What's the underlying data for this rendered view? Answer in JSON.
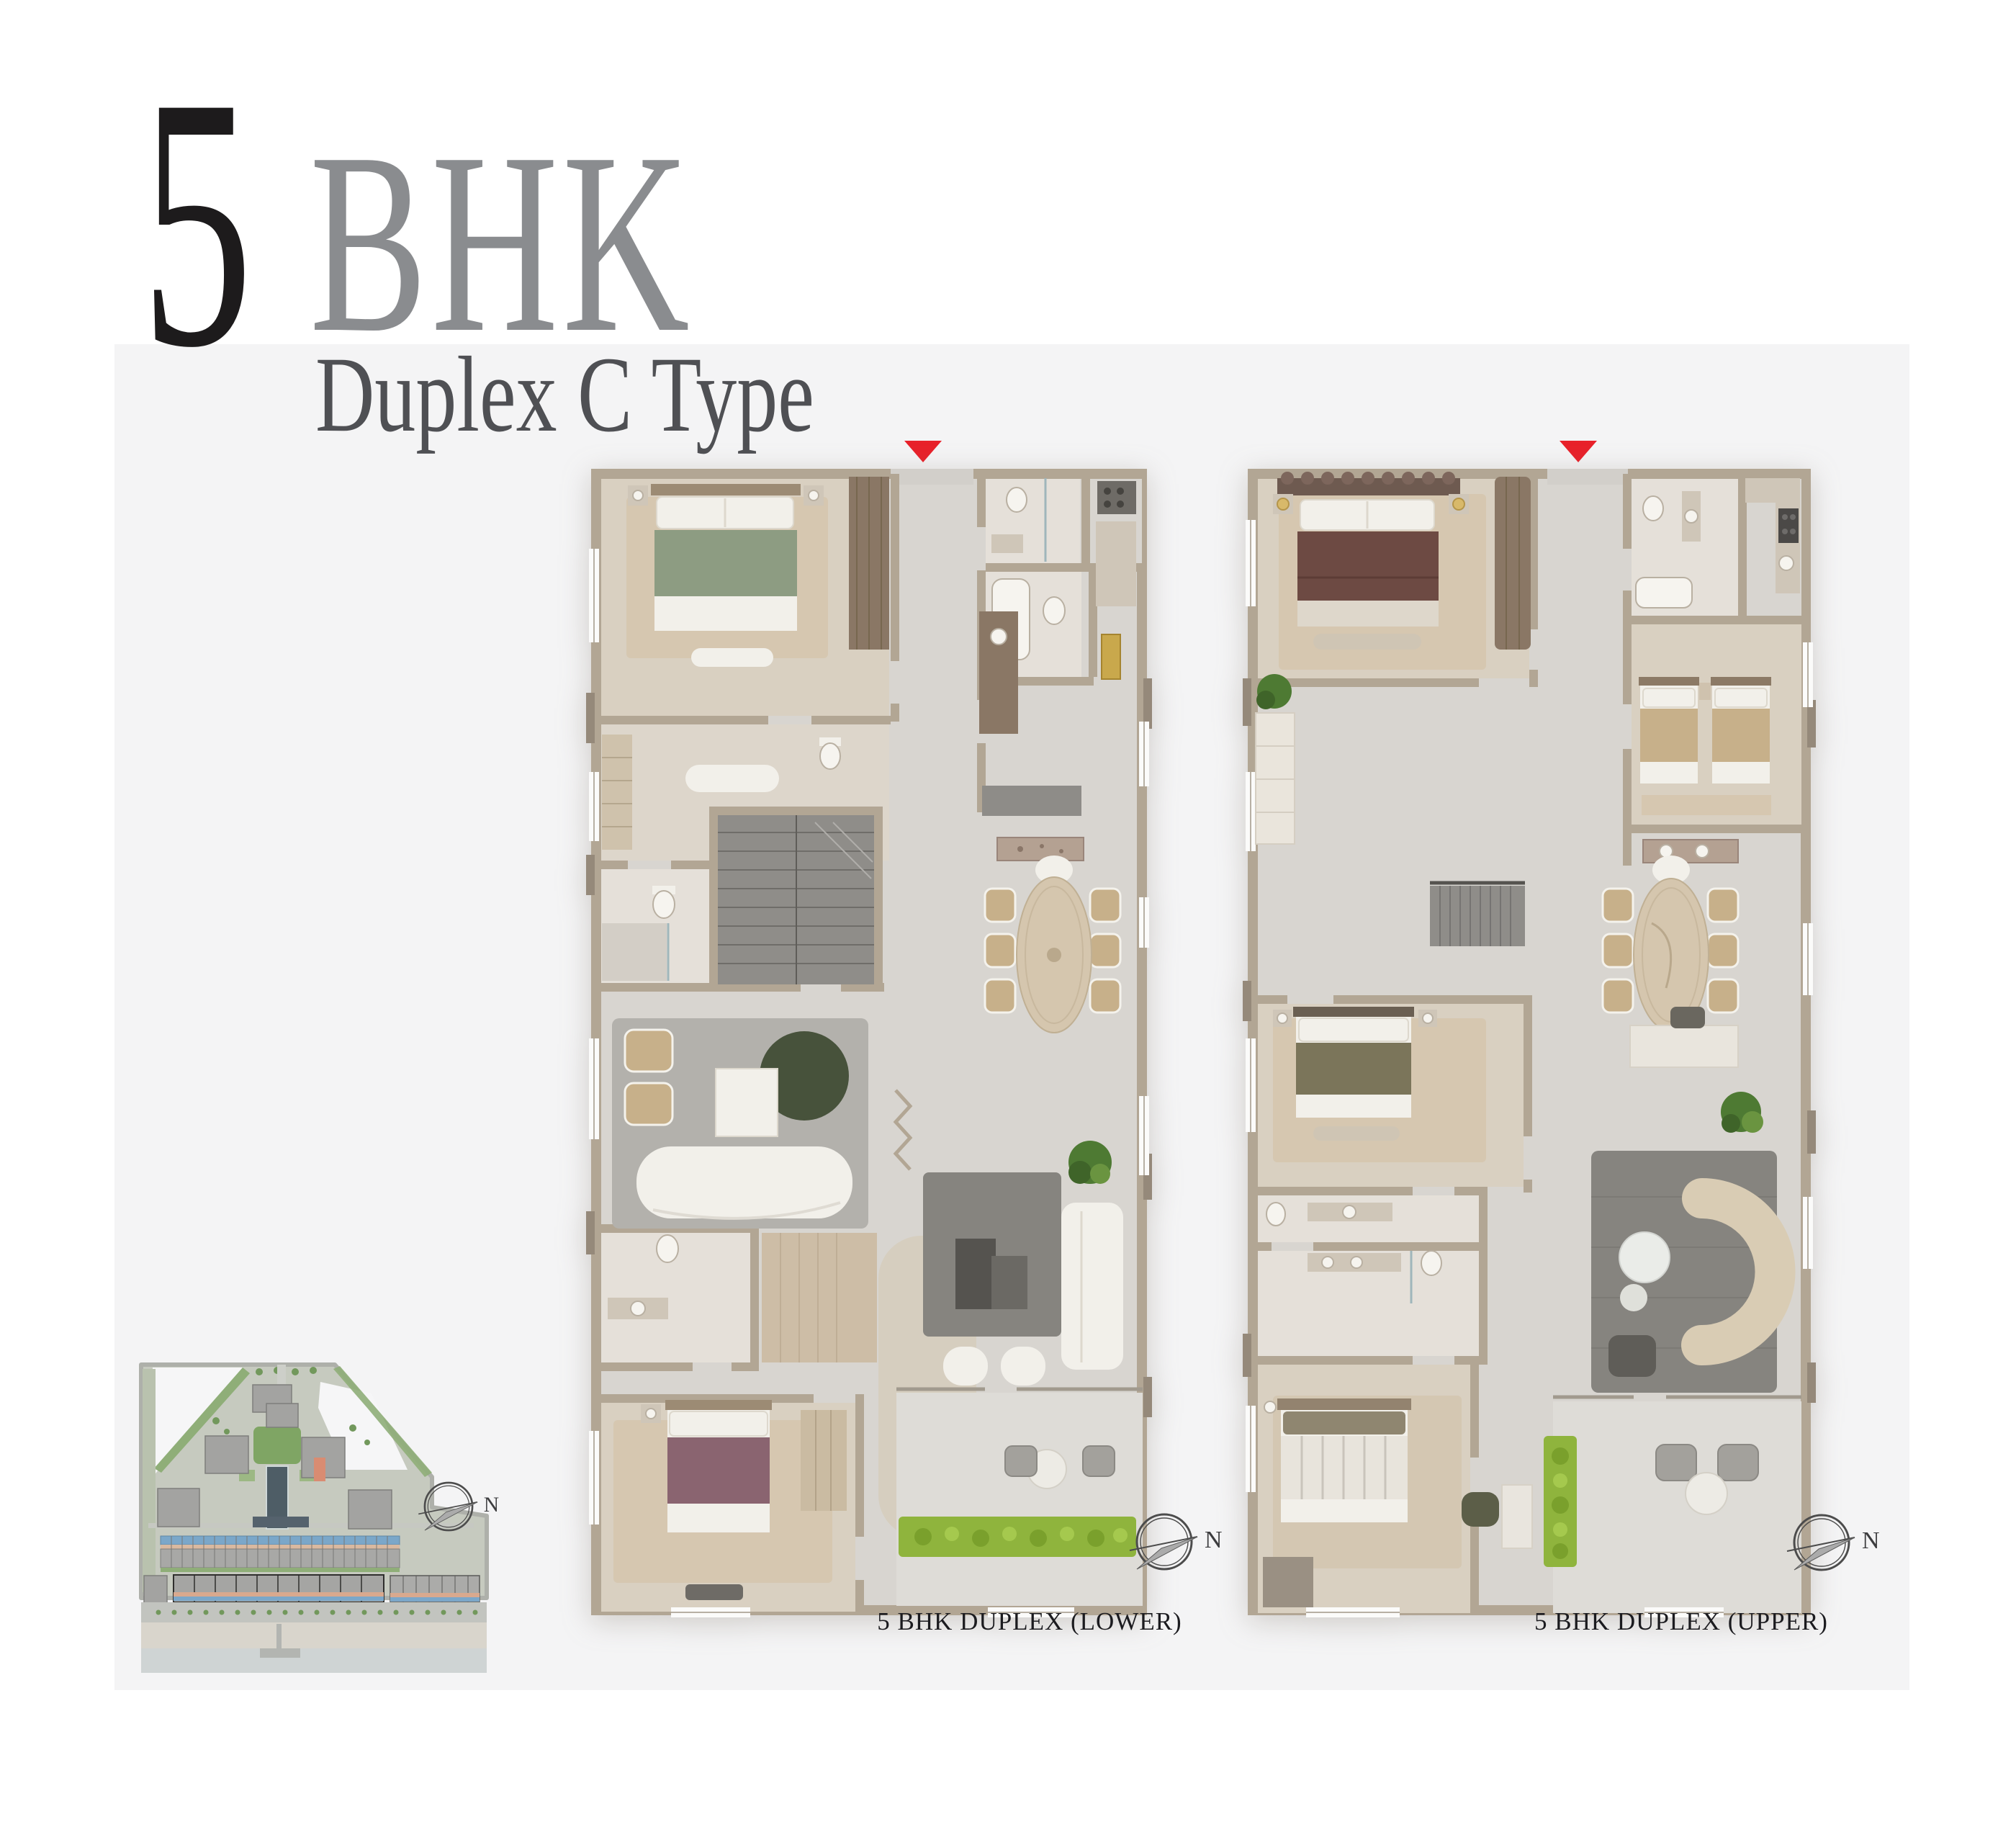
{
  "title": {
    "number": "5",
    "unit": "BHK",
    "subtitle": "Duplex C Type"
  },
  "captions": {
    "lower": "5 BHK DUPLEX (LOWER)",
    "upper": "5 BHK DUPLEX (UPPER)"
  },
  "compass": {
    "lower_label": "N",
    "upper_label": "N",
    "site_label": "N"
  },
  "markers": {
    "entry_color": "#e8212a"
  },
  "colors": {
    "panel": "#f4f4f5",
    "title_number": "#1d1b1c",
    "title_unit": "#8a8c8f",
    "subtitle": "#4f5054",
    "caption": "#1b1b1f",
    "wall": "#b2a694",
    "floor": "#d8d5d0",
    "hedge_green": "#8fb43d",
    "plant_green": "#4e7a33",
    "site_highlight": "#d98c72",
    "site_pool": "#4e5d66",
    "water": "#cfd4d4",
    "bed_green": "#8d9c82",
    "bed_maroon": "#6d4a43",
    "bed_olive": "#7b755a",
    "bed_plum": "#8a6470"
  }
}
